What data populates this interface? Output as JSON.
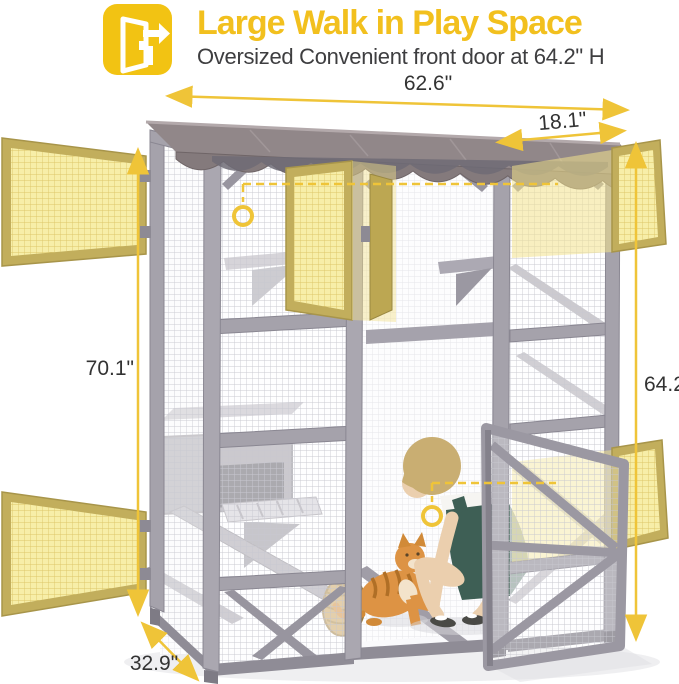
{
  "header": {
    "icon": "door-exit-icon",
    "title": "Large Walk in Play Space",
    "subtitle": "Oversized Convenient front door at 64.2\" H"
  },
  "annotations": {
    "top_width": "62.6\"",
    "top_door_width": "18.1\"",
    "left_height": "70.1\"",
    "door_height": "64.2\"",
    "bottom_depth": "32.9\""
  },
  "colors": {
    "accent_yellow": "#F2C313",
    "dimension_yellow": "#EFC438",
    "door_highlight": "#F7EEA8",
    "frame_gray": "#A5A2AB",
    "roof_taupe": "#918789",
    "label_text": "#333333"
  }
}
